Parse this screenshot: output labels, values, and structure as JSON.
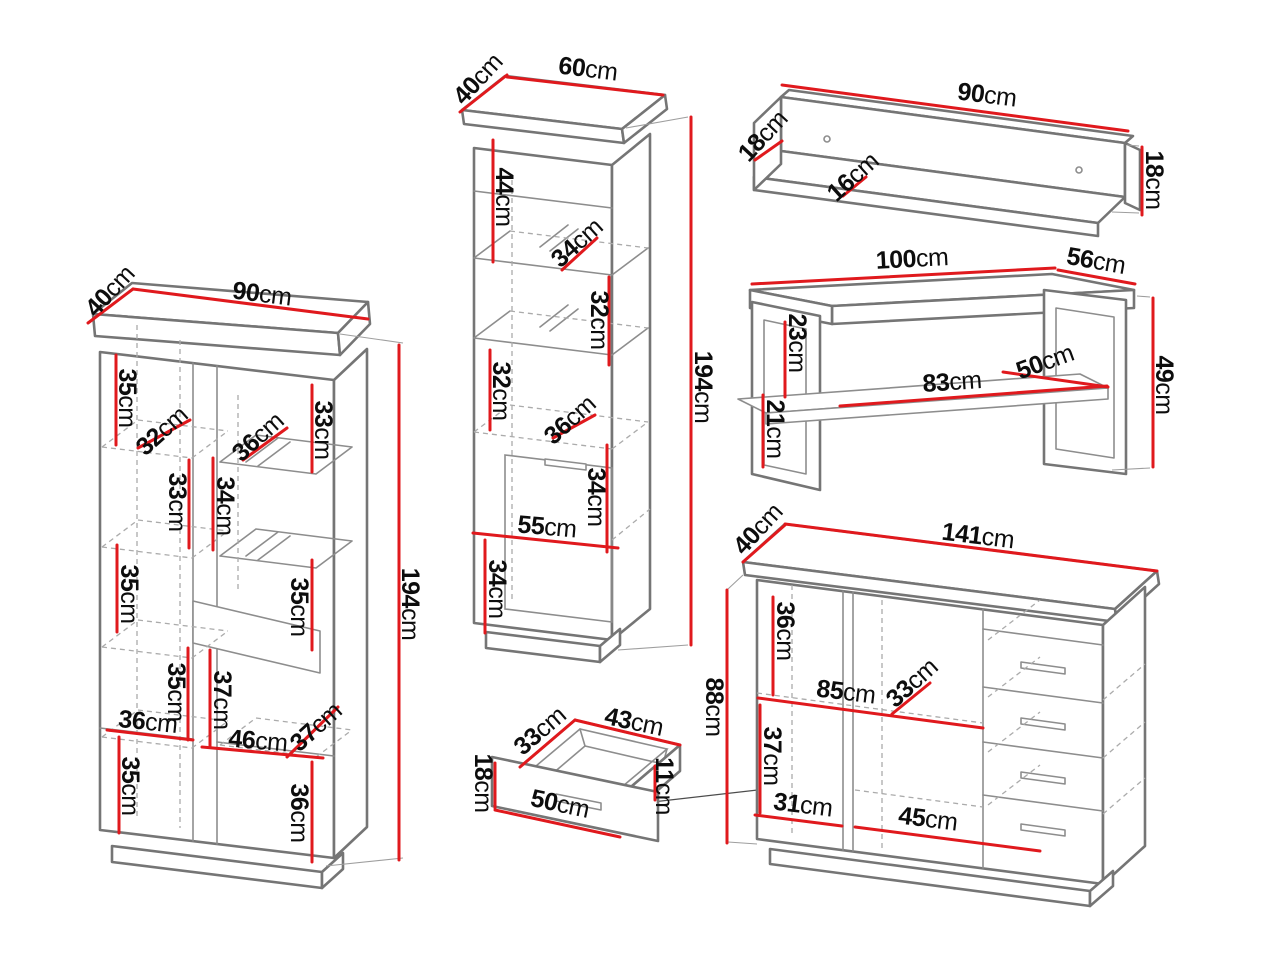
{
  "title": "Furniture wall-unit set — dimensioned line drawings",
  "unit_default": "cm",
  "colors": {
    "dimension_line": "#e0191d",
    "outline": "#757575",
    "outline_light": "#ababab",
    "label_text": "#0d0d0d",
    "background": "#ffffff"
  },
  "pieces": [
    {
      "id": "display-cabinet-90",
      "name": "Two-door display cabinet",
      "overall": {
        "width": "90cm",
        "depth": "40cm",
        "height": "194cm"
      },
      "labels": [
        {
          "v": "40",
          "u": "cm"
        },
        {
          "v": "90",
          "u": "cm"
        },
        {
          "v": "35",
          "u": "cm"
        },
        {
          "v": "32",
          "u": "cm"
        },
        {
          "v": "36",
          "u": "cm"
        },
        {
          "v": "33",
          "u": "cm"
        },
        {
          "v": "33",
          "u": "cm"
        },
        {
          "v": "34",
          "u": "cm"
        },
        {
          "v": "35",
          "u": "cm"
        },
        {
          "v": "35",
          "u": "cm"
        },
        {
          "v": "35",
          "u": "cm"
        },
        {
          "v": "37",
          "u": "cm"
        },
        {
          "v": "36",
          "u": "cm"
        },
        {
          "v": "46",
          "u": "cm"
        },
        {
          "v": "37",
          "u": "cm"
        },
        {
          "v": "35",
          "u": "cm"
        },
        {
          "v": "36",
          "u": "cm"
        },
        {
          "v": "194",
          "u": "cm"
        }
      ]
    },
    {
      "id": "display-cabinet-60",
      "name": "Tall single-door display cabinet",
      "overall": {
        "width": "60cm",
        "depth": "40cm",
        "height": "194cm"
      },
      "labels": [
        {
          "v": "40",
          "u": "cm"
        },
        {
          "v": "60",
          "u": "cm"
        },
        {
          "v": "44",
          "u": "cm"
        },
        {
          "v": "34",
          "u": "cm"
        },
        {
          "v": "32",
          "u": "cm"
        },
        {
          "v": "32",
          "u": "cm"
        },
        {
          "v": "36",
          "u": "cm"
        },
        {
          "v": "34",
          "u": "cm"
        },
        {
          "v": "55",
          "u": "cm"
        },
        {
          "v": "34",
          "u": "cm"
        },
        {
          "v": "194",
          "u": "cm"
        }
      ]
    },
    {
      "id": "wall-shelf",
      "name": "Wall shelf",
      "overall": {
        "width": "90cm",
        "depth": "18cm",
        "height": "18cm"
      },
      "labels": [
        {
          "v": "90",
          "u": "cm"
        },
        {
          "v": "18",
          "u": "cm"
        },
        {
          "v": "16",
          "u": "cm"
        },
        {
          "v": "18",
          "u": "cm"
        }
      ]
    },
    {
      "id": "coffee-table",
      "name": "Coffee table",
      "overall": {
        "width": "100cm",
        "depth": "56cm",
        "height": "49cm"
      },
      "labels": [
        {
          "v": "100",
          "u": "cm"
        },
        {
          "v": "56",
          "u": "cm"
        },
        {
          "v": "23",
          "u": "cm"
        },
        {
          "v": "21",
          "u": "cm"
        },
        {
          "v": "83",
          "u": "cm"
        },
        {
          "v": "50",
          "u": "cm"
        },
        {
          "v": "49",
          "u": "cm"
        }
      ]
    },
    {
      "id": "drawer-box",
      "name": "Pull-out drawer",
      "overall": {
        "width": "43cm",
        "depth": "33cm",
        "height": "18cm"
      },
      "labels": [
        {
          "v": "33",
          "u": "cm"
        },
        {
          "v": "43",
          "u": "cm"
        },
        {
          "v": "18",
          "u": "cm"
        },
        {
          "v": "50",
          "u": "cm"
        },
        {
          "v": "11",
          "u": "cm"
        }
      ]
    },
    {
      "id": "sideboard",
      "name": "Sideboard with four drawers",
      "overall": {
        "width": "141cm",
        "depth": "40cm",
        "height": "88cm"
      },
      "labels": [
        {
          "v": "40",
          "u": "cm"
        },
        {
          "v": "141",
          "u": "cm"
        },
        {
          "v": "88",
          "u": "cm"
        },
        {
          "v": "36",
          "u": "cm"
        },
        {
          "v": "85",
          "u": "cm"
        },
        {
          "v": "33",
          "u": "cm"
        },
        {
          "v": "37",
          "u": "cm"
        },
        {
          "v": "31",
          "u": "cm"
        },
        {
          "v": "45",
          "u": "cm"
        }
      ]
    }
  ]
}
